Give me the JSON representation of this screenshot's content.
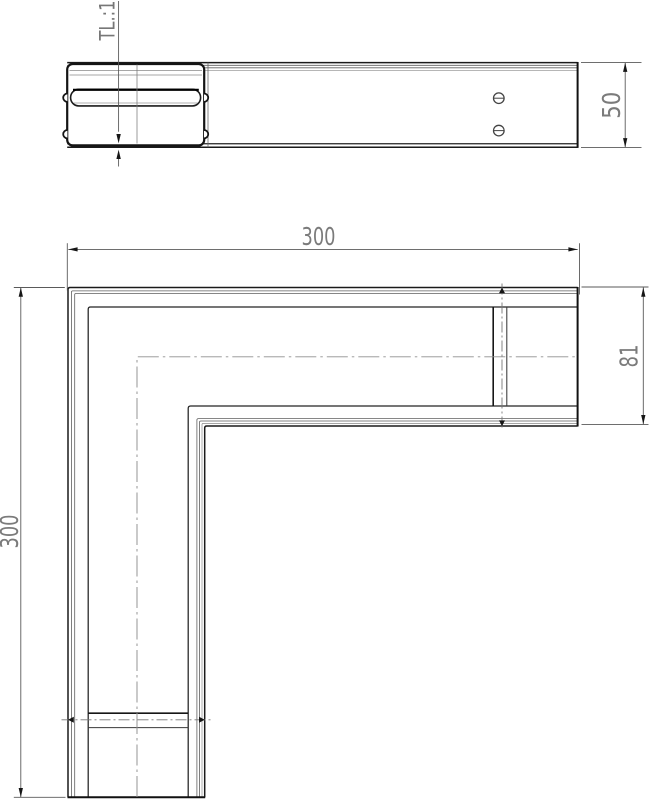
{
  "drawing": {
    "background_color": "#ffffff",
    "outline_color": "#1a1a1a",
    "dimension_line_color": "#5a5a5a",
    "dimension_text_color": "#7b7b7b",
    "centerline_color": "#8f8f8f",
    "labels": {
      "part_label": "TL.:1",
      "dim_top_width": "300",
      "dim_left_height": "300",
      "dim_profile_height": "81",
      "dim_side_height": "50"
    }
  }
}
